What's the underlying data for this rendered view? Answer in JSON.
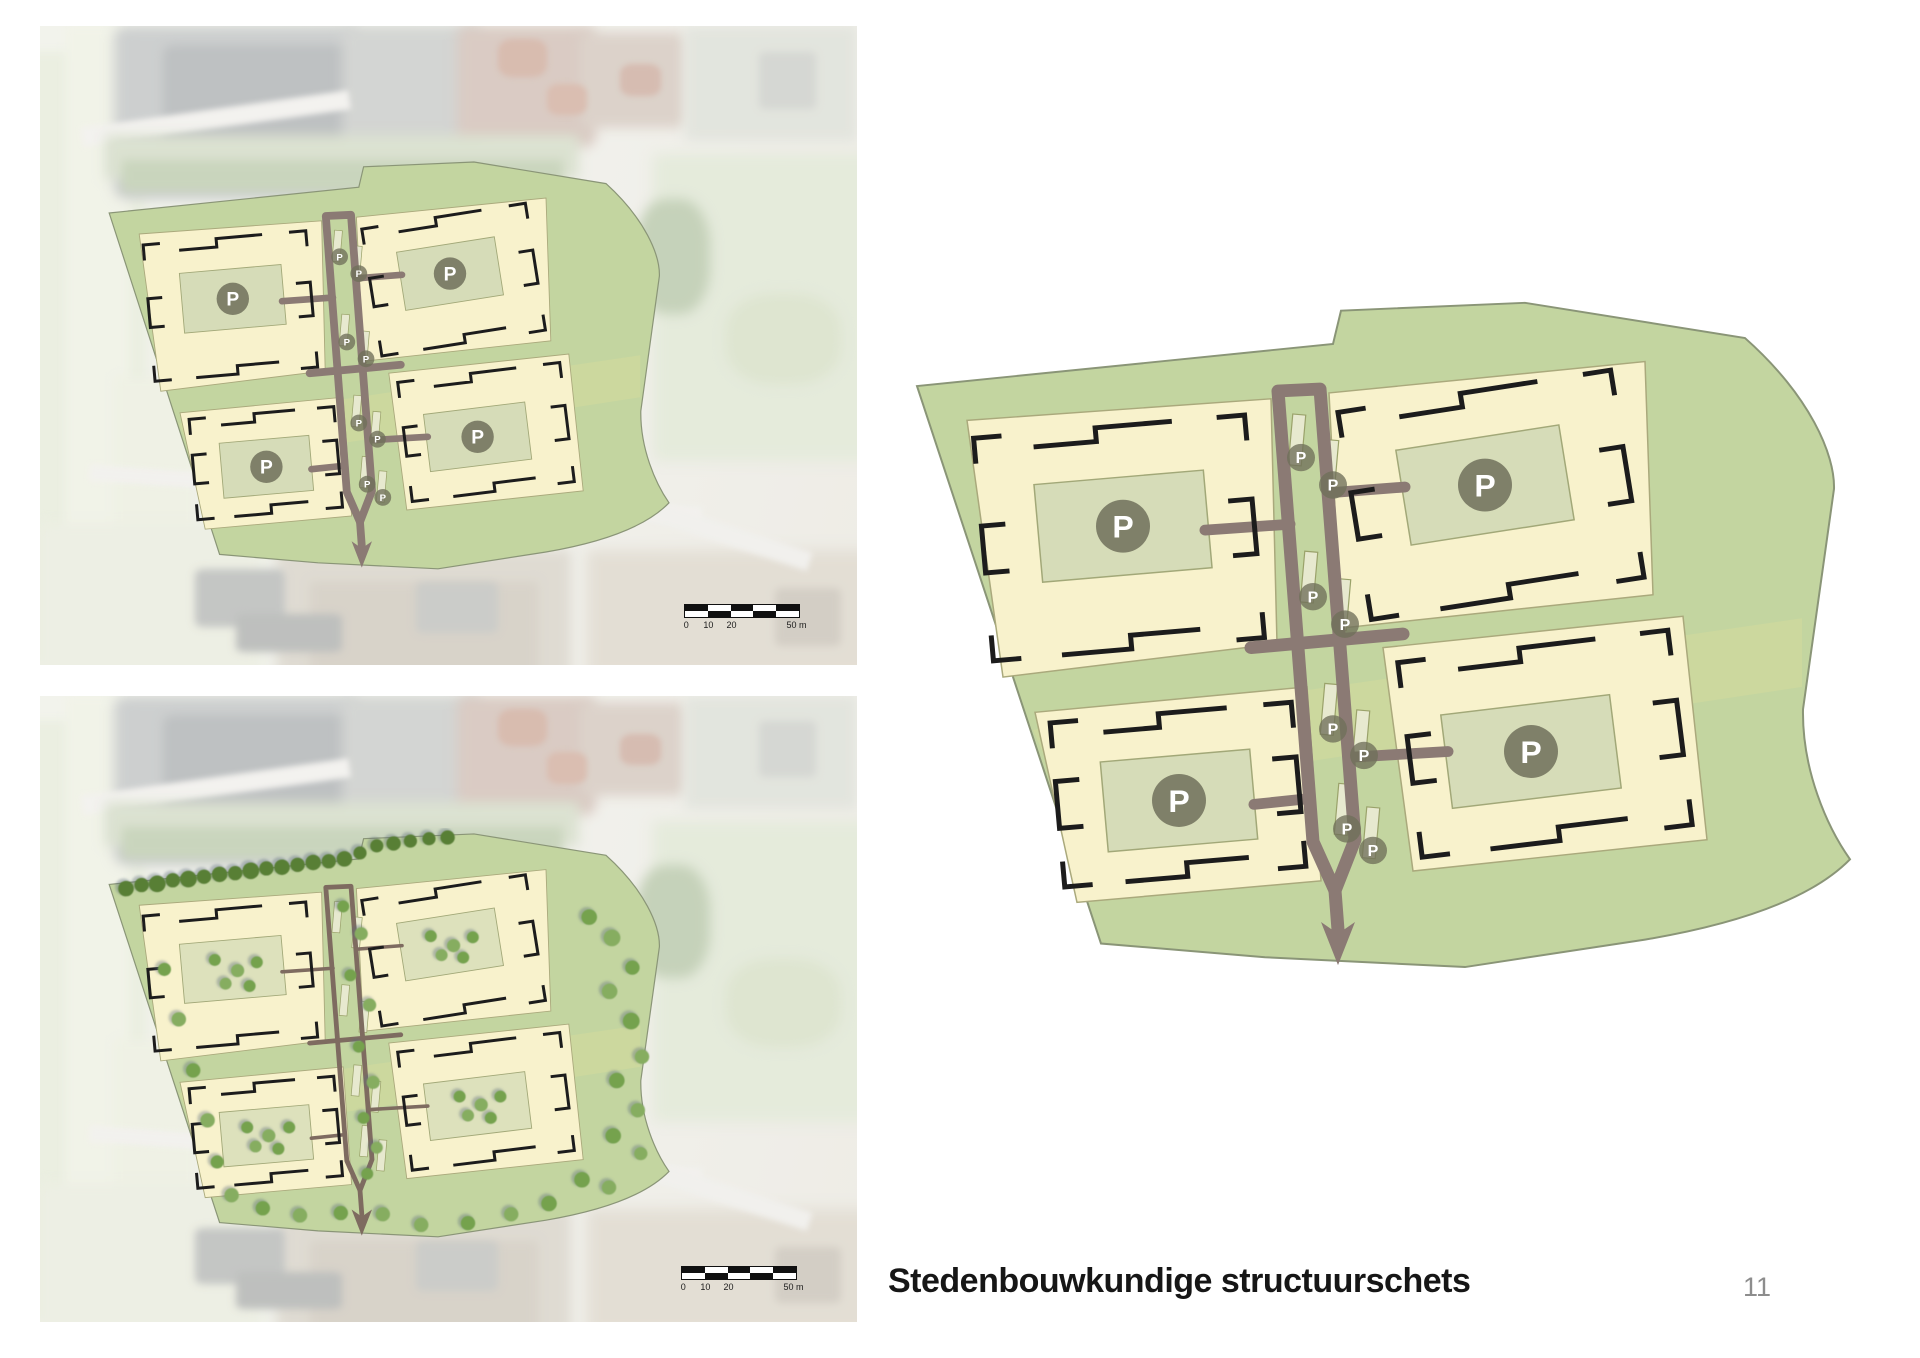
{
  "title": "Stedenbouwkundige structuurschets",
  "page": {
    "number": "11"
  },
  "scalebar": {
    "labels": [
      "0",
      "10",
      "20",
      "50 m"
    ]
  },
  "plan": {
    "p_label": "P",
    "p_small_label": "P",
    "colors": {
      "site_green": "#c3d5a0",
      "site_border": "#8a9577",
      "band_green": "#ccd89e",
      "parcel_yellow": "#f8f2cc",
      "parcel_border": "#aaa97c",
      "lot_fill": "#d6dcb8",
      "lot_border": "#a2a878",
      "road": "#8b7a74",
      "road_thin": "#7e6b60",
      "building": "#1c1c1c",
      "badge": "#70705a",
      "badge_text": "#ffffff",
      "strip_fill": "#e7e9cf",
      "strip_border": "#9aa26a",
      "tree_dark": "#587f36",
      "tree_mid": "#74a24e",
      "tree_light": "#86ad60",
      "tree_shadow": "#5b6c78"
    }
  }
}
